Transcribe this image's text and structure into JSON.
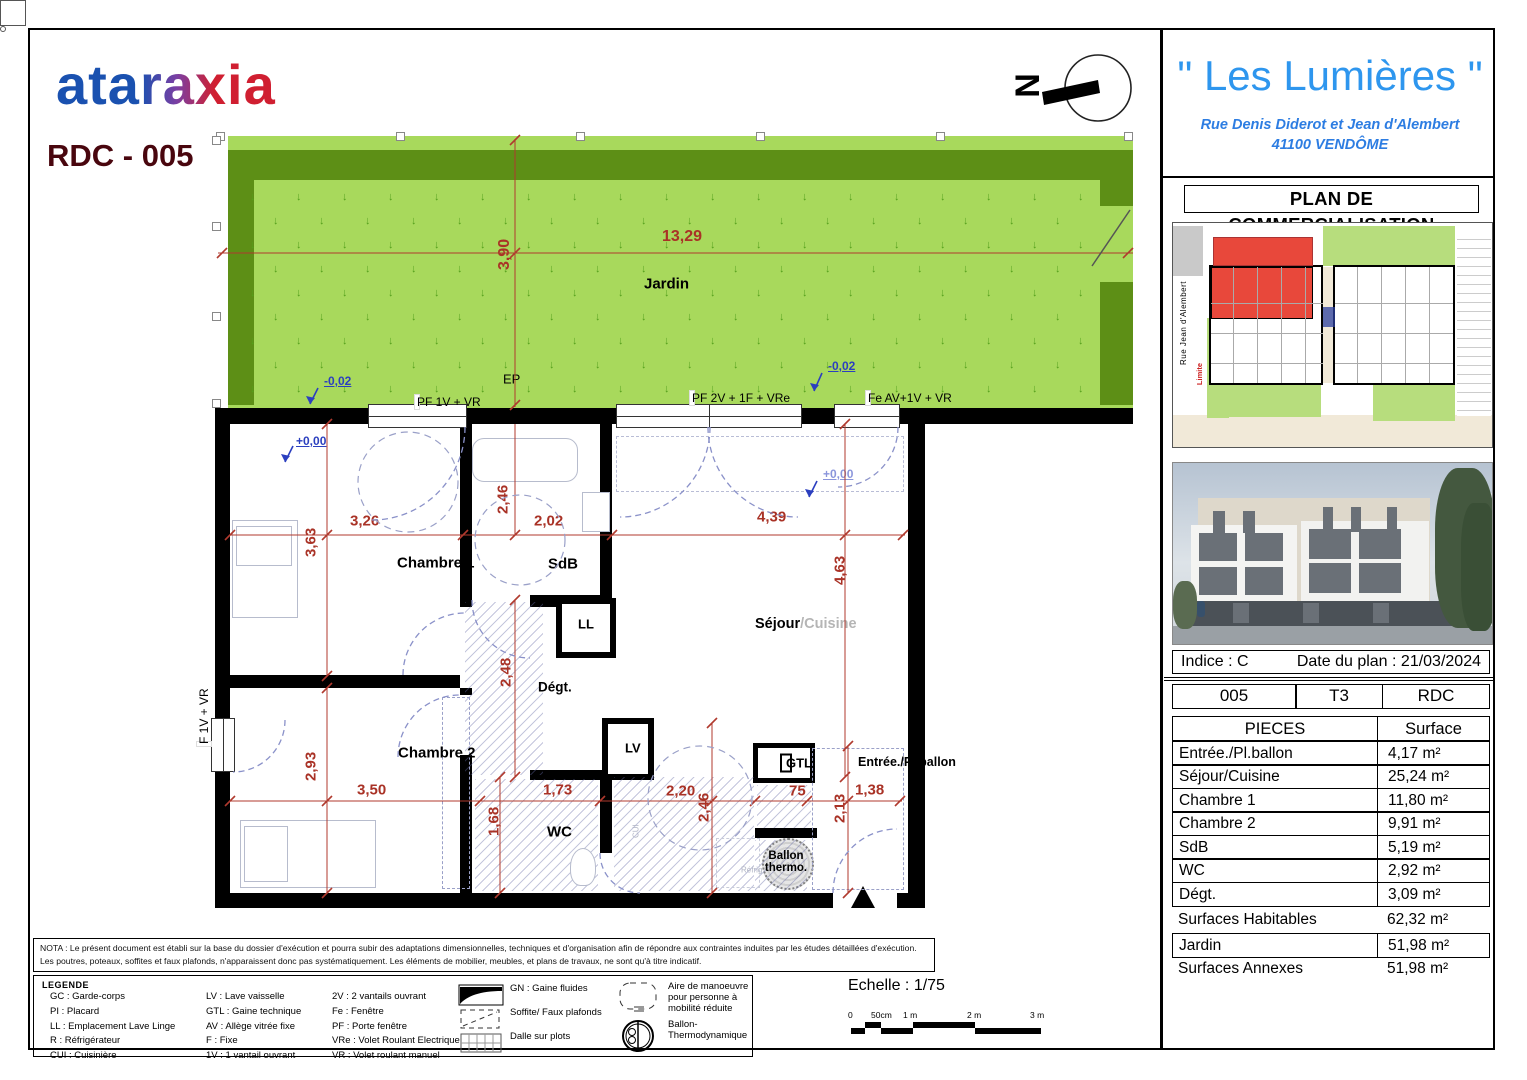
{
  "branding": {
    "logo": "ataraxia",
    "unit_ref": "RDC - 005"
  },
  "project": {
    "title": "\" Les Lumières \"",
    "address_line1": "Rue Denis Diderot et Jean d'Alembert",
    "address_line2": "41100 VENDÔME",
    "doc_title": "PLAN DE COMMERCIALISATION"
  },
  "site_plan": {
    "caption": "PLAN DE REPERAGE - SANS ECHELLE",
    "street_left": "Rue Jean d'Alembert",
    "street_bottom": "Rue Denis Diderot",
    "limite_left": "Limite",
    "limite_right": "Limite",
    "limite_bottom": "Limite",
    "highlight_color": "#e8483b"
  },
  "meta": {
    "indice": "Indice : C",
    "date": "Date du plan : 21/03/2024",
    "unit_number": "005",
    "unit_type": "T3",
    "unit_floor": "RDC"
  },
  "surface_table": {
    "headers": [
      "PIECES",
      "Surface"
    ],
    "rows": [
      [
        "Entrée./Pl.ballon",
        "4,17 m²"
      ],
      [
        "Séjour/Cuisine",
        "25,24 m²"
      ],
      [
        "Chambre 1",
        "11,80 m²"
      ],
      [
        "Chambre 2",
        "9,91 m²"
      ],
      [
        "SdB",
        "5,19 m²"
      ],
      [
        "WC",
        "2,92 m²"
      ],
      [
        "Dégt.",
        "3,09 m²"
      ]
    ],
    "totals": [
      {
        "label": "Surfaces Habitables",
        "value": "62,32 m²",
        "boxed": false
      },
      {
        "label": "Jardin",
        "value": "51,98 m²",
        "boxed": true
      },
      {
        "label": "Surfaces Annexes",
        "value": "51,98 m²",
        "boxed": false
      }
    ]
  },
  "plan": {
    "north": "N",
    "sejour": {
      "main": "Séjour",
      "sub": "/Cuisine"
    },
    "rooms": [
      {
        "id": "jardin",
        "text": "Jardin"
      },
      {
        "id": "ch1",
        "text": "Chambre 1"
      },
      {
        "id": "sdb",
        "text": "SdB"
      },
      {
        "id": "ll",
        "text": "LL"
      },
      {
        "id": "degt",
        "text": "Dégt."
      },
      {
        "id": "ch2",
        "text": "Chambre 2"
      },
      {
        "id": "wc",
        "text": "WC"
      },
      {
        "id": "lv",
        "text": "LV"
      },
      {
        "id": "gtl",
        "text": "GTL"
      },
      {
        "id": "entree",
        "text": "Entrée./Pl.ballon"
      },
      {
        "id": "ballon",
        "text": "Ballon thermo."
      },
      {
        "id": "ep",
        "text": "EP"
      },
      {
        "id": "refrig",
        "text": "Réfrig."
      },
      {
        "id": "cui",
        "text": "CUI"
      }
    ],
    "dims": [
      {
        "id": "g1",
        "text": "13,29"
      },
      {
        "id": "g2",
        "text": "3,90"
      },
      {
        "id": "d326",
        "text": "3,26"
      },
      {
        "id": "d246a",
        "text": "2,46"
      },
      {
        "id": "d202",
        "text": "2,02"
      },
      {
        "id": "d439",
        "text": "4,39"
      },
      {
        "id": "d363",
        "text": "3,63"
      },
      {
        "id": "d463",
        "text": "4,63"
      },
      {
        "id": "d248",
        "text": "2,48"
      },
      {
        "id": "d293",
        "text": "2,93"
      },
      {
        "id": "d350",
        "text": "3,50"
      },
      {
        "id": "d173",
        "text": "1,73"
      },
      {
        "id": "d220",
        "text": "2,20"
      },
      {
        "id": "d75",
        "text": "75"
      },
      {
        "id": "d138",
        "text": "1,38"
      },
      {
        "id": "d168",
        "text": "1,68"
      },
      {
        "id": "d246b",
        "text": "2,46"
      },
      {
        "id": "d213",
        "text": "2,13"
      }
    ],
    "levels": [
      {
        "id": "lv1",
        "text": "+0,00"
      },
      {
        "id": "lv2",
        "text": "-0,02"
      },
      {
        "id": "lv3",
        "text": "-0,02"
      },
      {
        "id": "lv4",
        "text": "+0,00"
      }
    ],
    "windows": [
      {
        "id": "w1",
        "text": "PF 1V + VR"
      },
      {
        "id": "w2",
        "text": "PF 2V + 1F + VRe"
      },
      {
        "id": "w3",
        "text": "Fe AV+1V + VR"
      },
      {
        "id": "w4",
        "text": "F 1V + VR"
      }
    ]
  },
  "nota": {
    "line1": "NOTA : Le présent document est établi sur la base du dossier d'exécution et pourra subir des adaptations dimensionnelles, techniques et d'organisation afin de répondre aux contraintes induites par les études détaillées d'exécution.",
    "line2": "Les poutres, poteaux, soffites et faux plafonds, n'apparaissent donc pas systématiquement. Les éléments de mobilier, meubles, et plans de travaux, ne sont qu'à titre indicatif."
  },
  "legend": {
    "title": "LEGENDE",
    "col1": [
      "GC : Garde-corps",
      "PI : Placard",
      "LL : Emplacement Lave Linge",
      "R : Réfrigérateur",
      "CUI : Cuisinière"
    ],
    "col2": [
      "LV : Lave vaisselle",
      "GTL : Gaine technique",
      "AV : Allège vitrée fixe",
      "F : Fixe",
      "1V : 1 vantail ouvrant"
    ],
    "col3": [
      "2V : 2 vantails ouvrant",
      "Fe : Fenêtre",
      "PF : Porte fenêtre",
      "VRe : Volet Roulant Electrique",
      "VR : Volet roulant manuel"
    ],
    "icons": [
      {
        "id": "gn",
        "name": "gaine-fluides-icon",
        "label": "GN : Gaine fluides"
      },
      {
        "id": "soffite",
        "name": "soffite-icon",
        "label": "Soffite/ Faux plafonds"
      },
      {
        "id": "dalle",
        "name": "dalle-sur-plots-icon",
        "label": "Dalle sur plots"
      },
      {
        "id": "pmr",
        "name": "aire-manoeuvre-icon",
        "label": "Aire de manoeuvre\npour personne à\nmobilité réduite"
      },
      {
        "id": "ballon",
        "name": "ballon-thermodynamique-icon",
        "label": "Ballon-\nThermodynamique"
      }
    ]
  },
  "scale": {
    "label": "Echelle : 1/75",
    "ticks": [
      "0",
      "50cm",
      "1 m",
      "2 m",
      "3 m"
    ]
  },
  "colors": {
    "garden_fill": "#a8d95c",
    "hedge": "#5d8f16",
    "dim_red": "#a93226",
    "level_blue": "#2b3fbf",
    "title_blue": "#2e96ee",
    "unit_red": "#e8483b"
  }
}
